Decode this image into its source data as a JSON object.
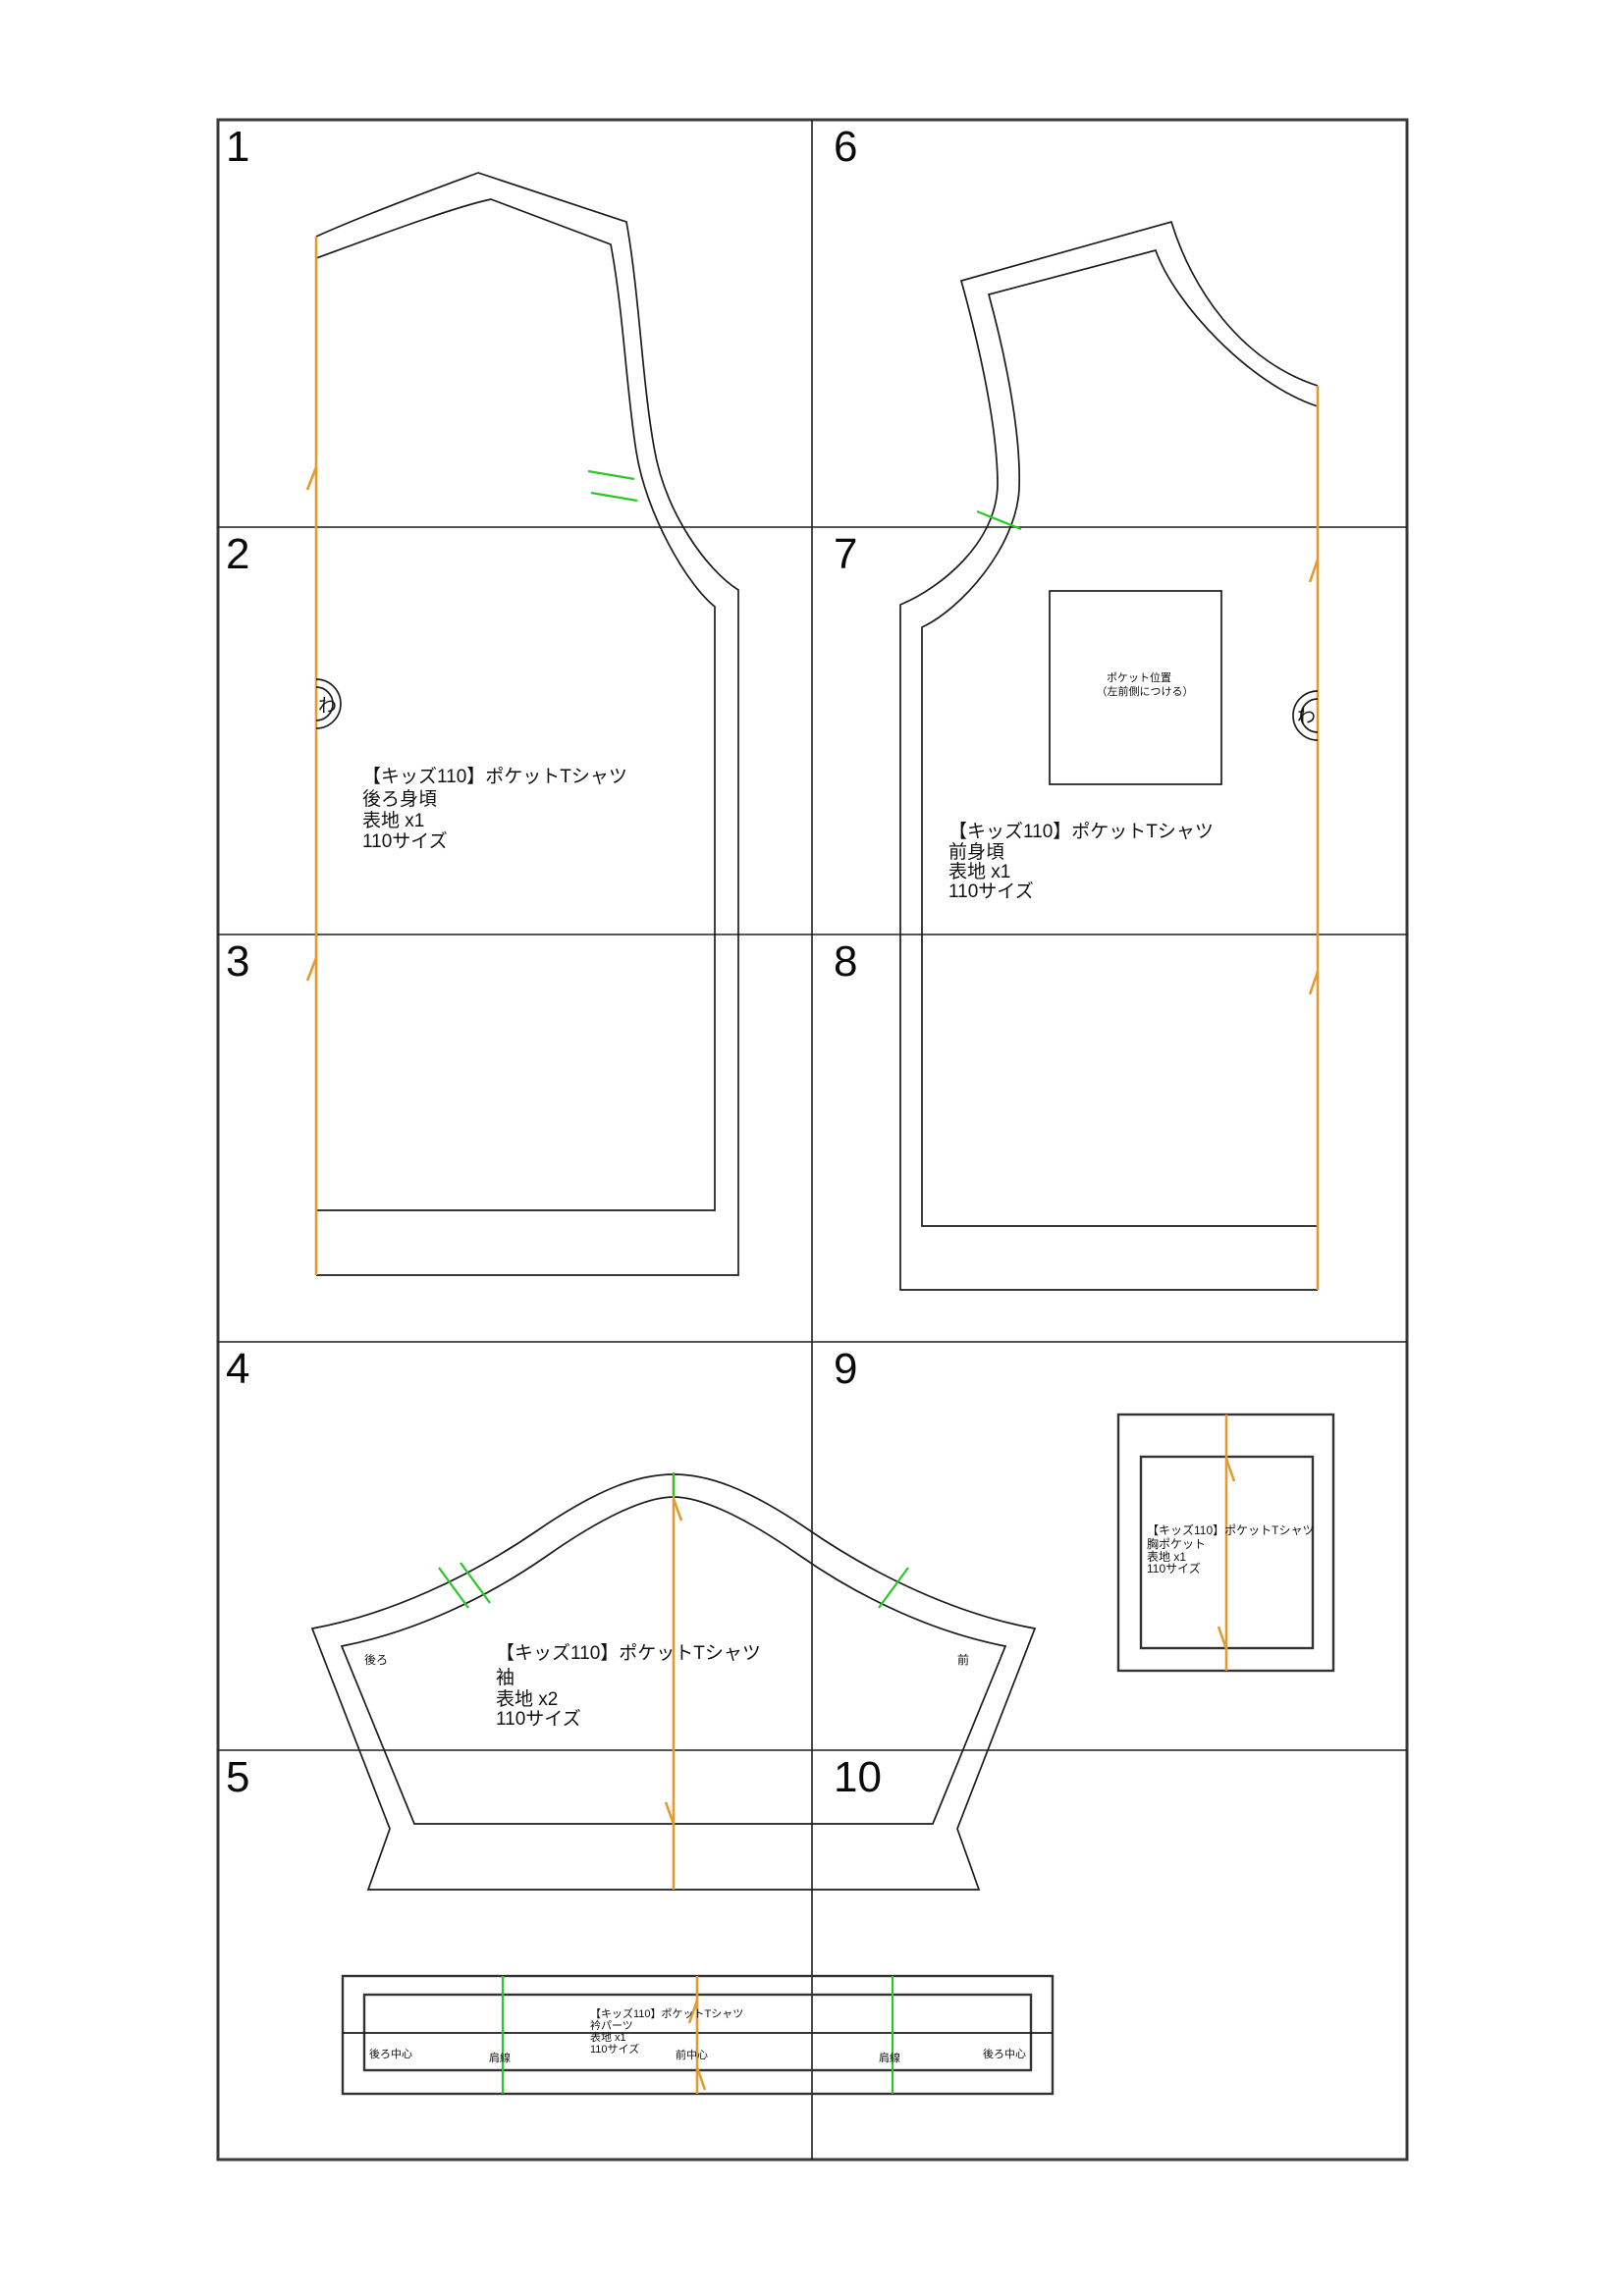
{
  "colors": {
    "grain_line": "#e39a2e",
    "notch_mark": "#28c828",
    "grid_line": "#1f1f1f",
    "pattern_line": "#1c1c1c",
    "background": "#ffffff"
  },
  "tiles": [
    "1",
    "2",
    "3",
    "4",
    "5",
    "6",
    "7",
    "8",
    "9",
    "10"
  ],
  "fold_mark": "わ",
  "back": {
    "lines": [
      "【キッズ110】ポケットTシャツ",
      "後ろ身頃",
      "表地 x1",
      "110サイズ"
    ]
  },
  "front": {
    "lines": [
      "【キッズ110】ポケットTシャツ",
      "前身頃",
      "表地 x1",
      "110サイズ"
    ],
    "pocket_position": [
      "ポケット位置",
      "（左前側につける）"
    ]
  },
  "sleeve": {
    "lines": [
      "【キッズ110】ポケットTシャツ",
      "袖",
      "表地 x2",
      "110サイズ"
    ],
    "side_back": "後ろ",
    "side_front": "前"
  },
  "pocket": {
    "lines": [
      "【キッズ110】ポケットTシャツ",
      "胸ポケット",
      "表地 x1",
      "110サイズ"
    ]
  },
  "collar": {
    "lines": [
      "【キッズ110】ポケットTシャツ",
      "衿パーツ",
      "表地 x1",
      "110サイズ"
    ],
    "back_center_left": "後ろ中心",
    "shoulder_left": "肩線",
    "front_center": "前中心",
    "shoulder_right": "肩線",
    "back_center_right": "後ろ中心"
  }
}
